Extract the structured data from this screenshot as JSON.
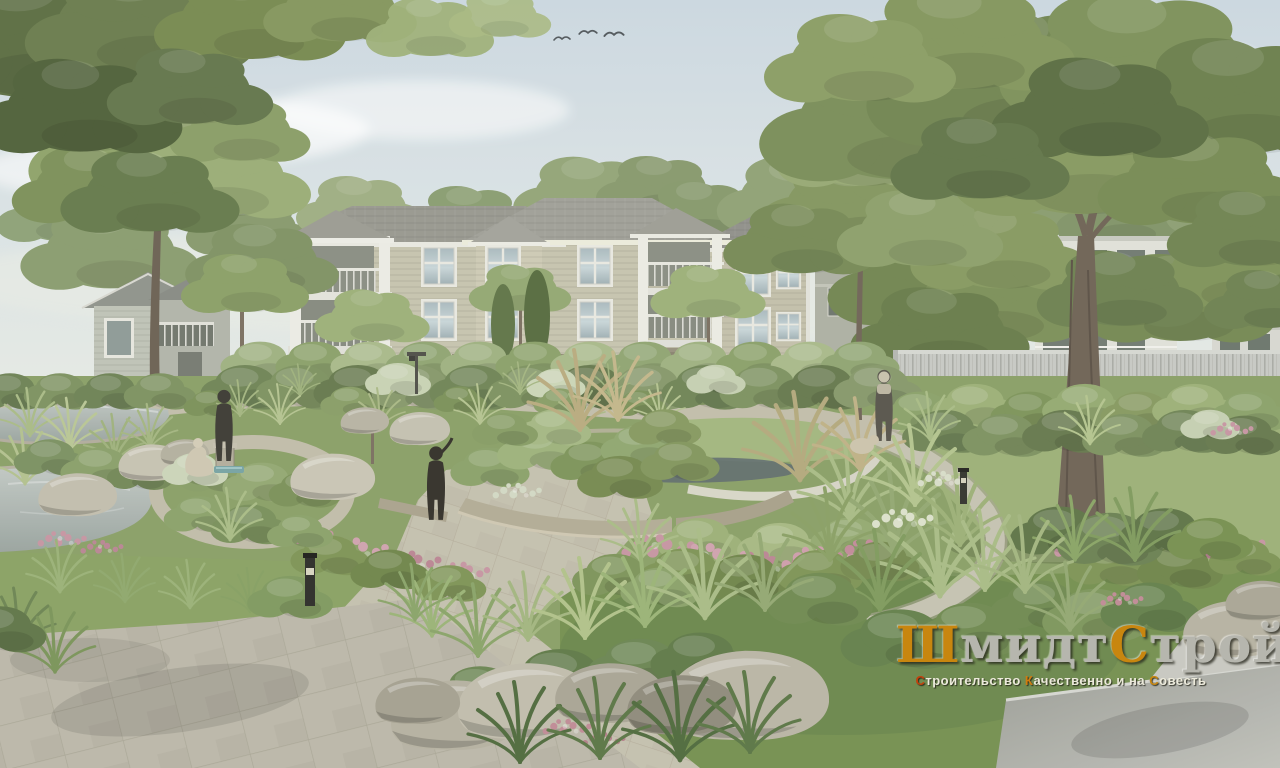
{
  "watermark": {
    "title": {
      "p1": "Ш",
      "p2": "мидт",
      "p3": "С",
      "p4": "трой"
    },
    "tagline": {
      "p1": "С",
      "p2": "троительство",
      "p3": "К",
      "p4": "ачественно и на",
      "p5": "С",
      "p6": "овесть"
    },
    "colors": {
      "gold": "#c8860f",
      "silver": "#b6b6ae",
      "red": "#c2410c",
      "amber": "#d07c10",
      "white": "#eceadb"
    }
  }
}
